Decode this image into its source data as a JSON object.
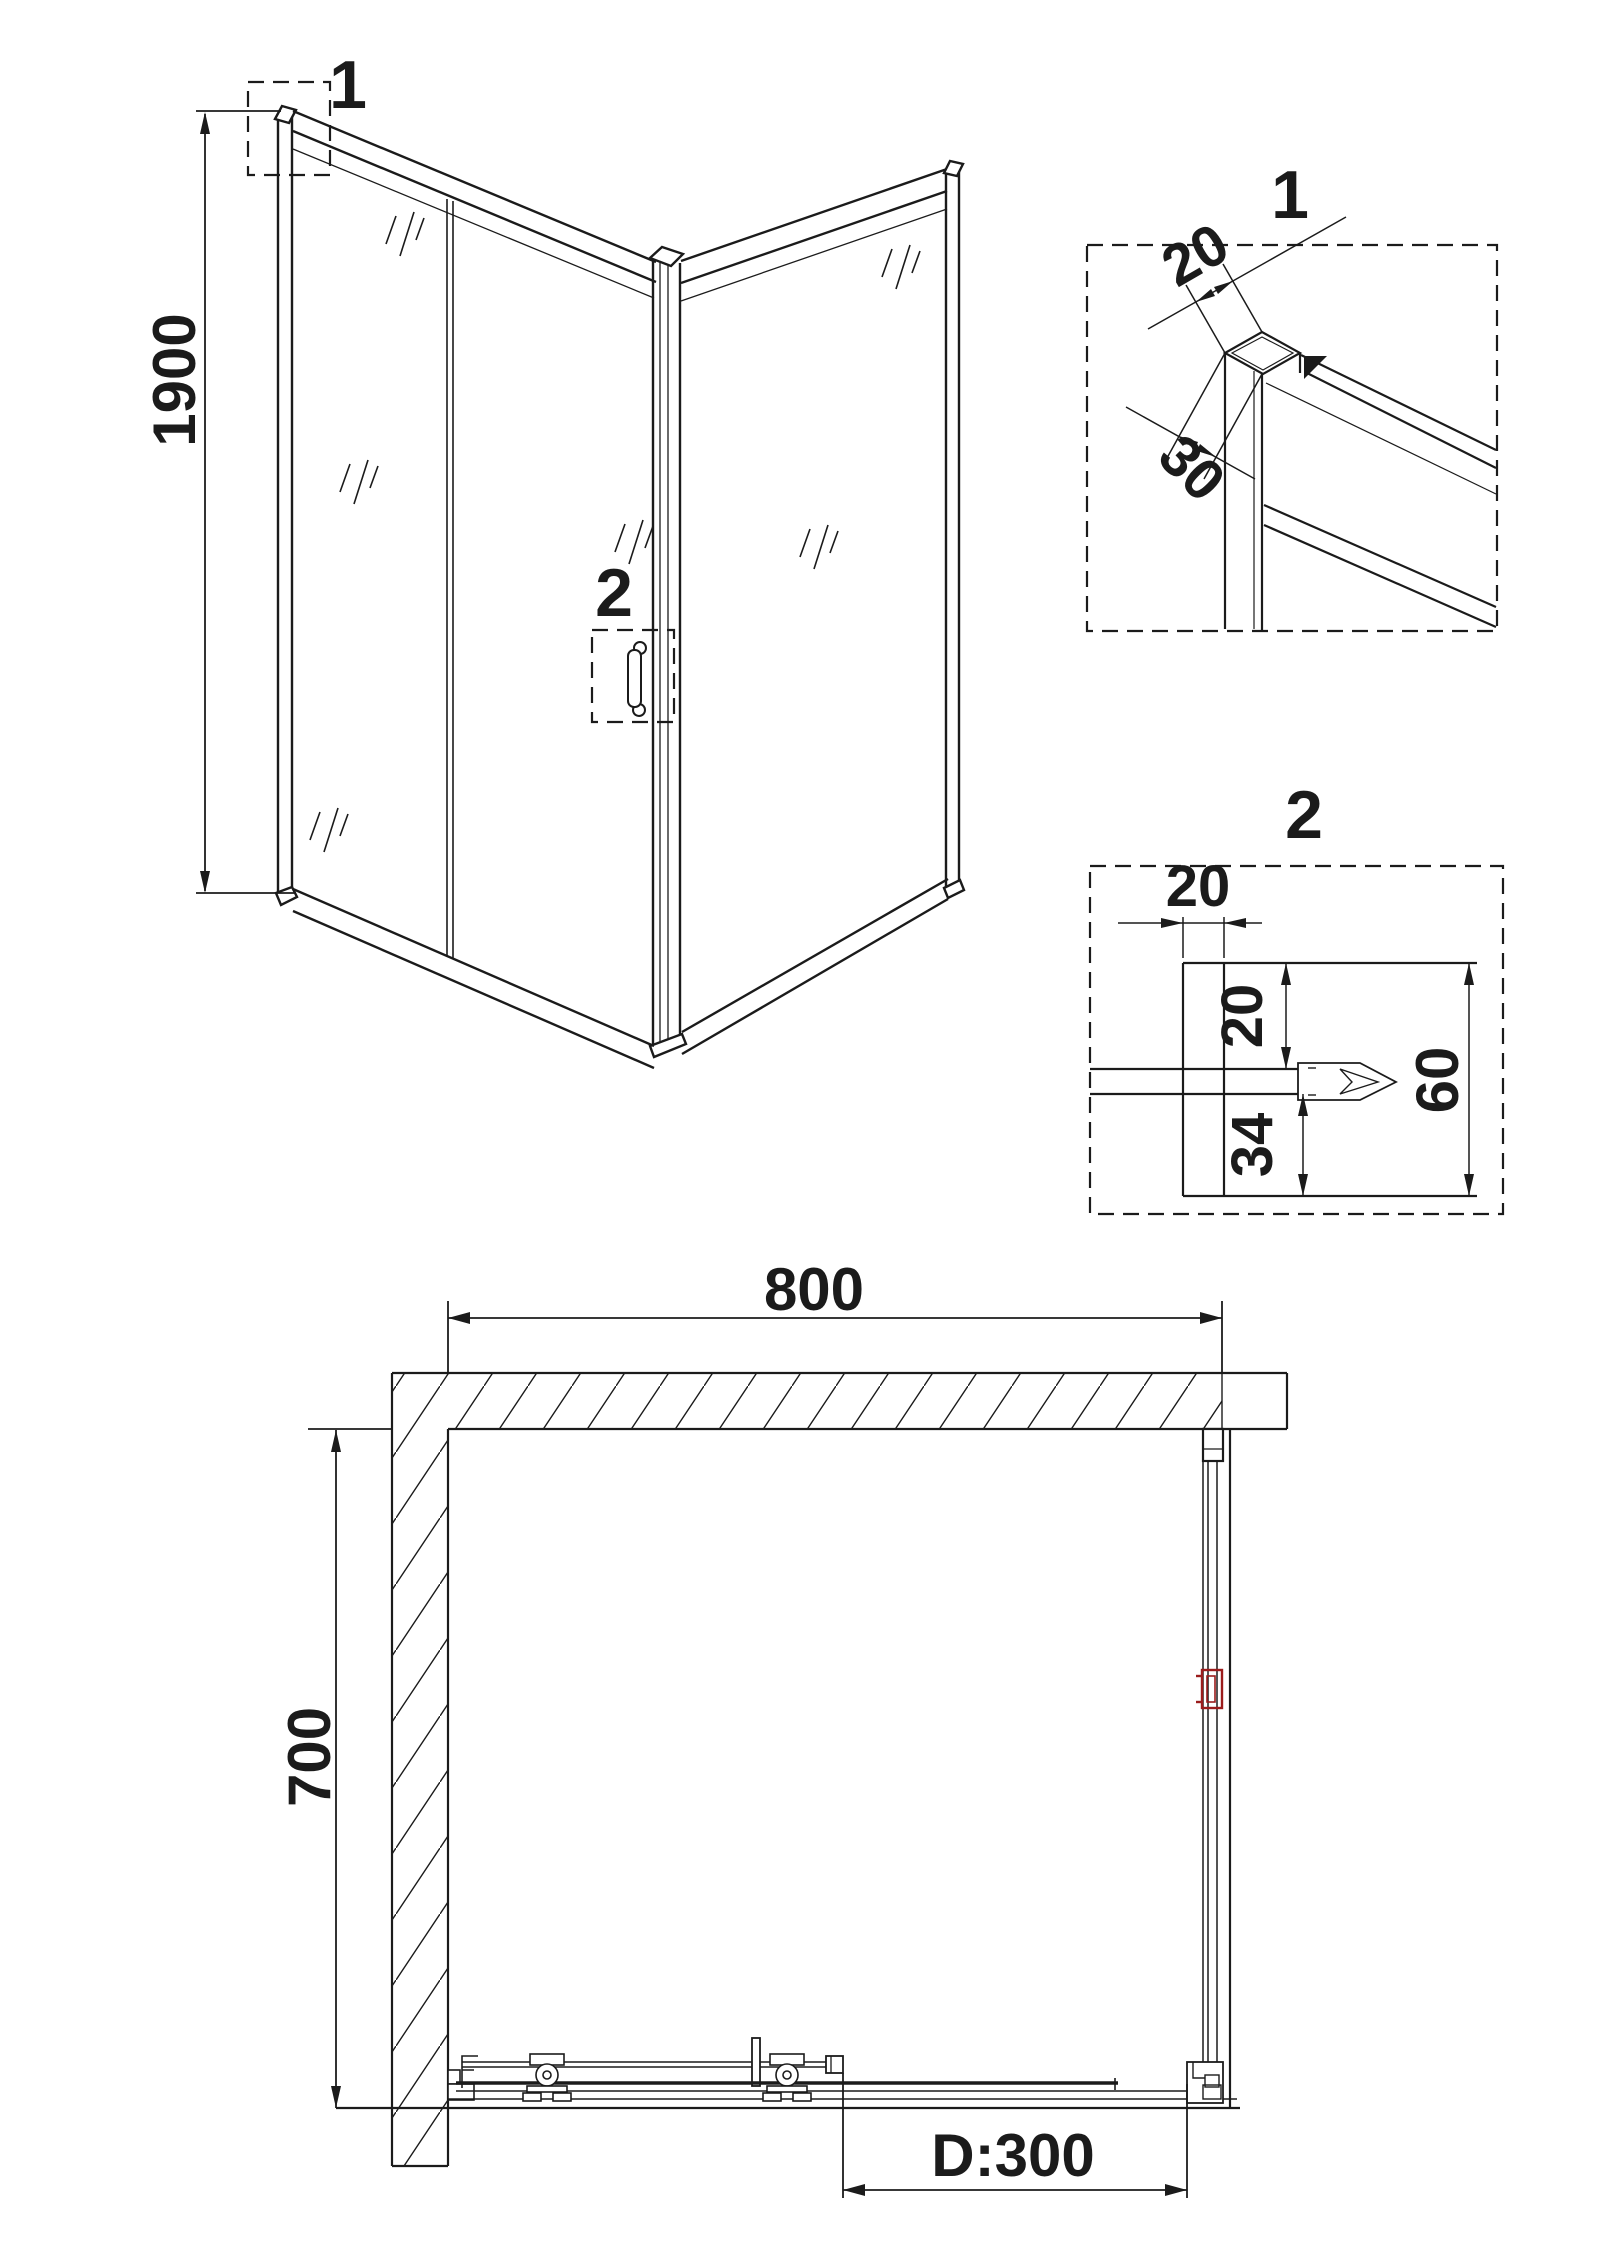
{
  "drawing": {
    "type": "shower-enclosure-technical-drawing",
    "colors": {
      "line": "#1b1b1b",
      "accent_red": "#9b1c1c",
      "background": "#ffffff"
    },
    "iso_view": {
      "height_dim": "1900",
      "callout_top": "1",
      "callout_handle": "2"
    },
    "detail_1": {
      "label": "1",
      "width_dim": "20",
      "depth_dim": "30"
    },
    "detail_2": {
      "label": "2",
      "profile_width_dim": "20",
      "upper_gap_dim": "20",
      "lower_gap_dim": "34",
      "overall_height_dim": "60"
    },
    "plan_view": {
      "width_dim": "800",
      "depth_dim": "700",
      "door_dim": "D:300"
    }
  }
}
